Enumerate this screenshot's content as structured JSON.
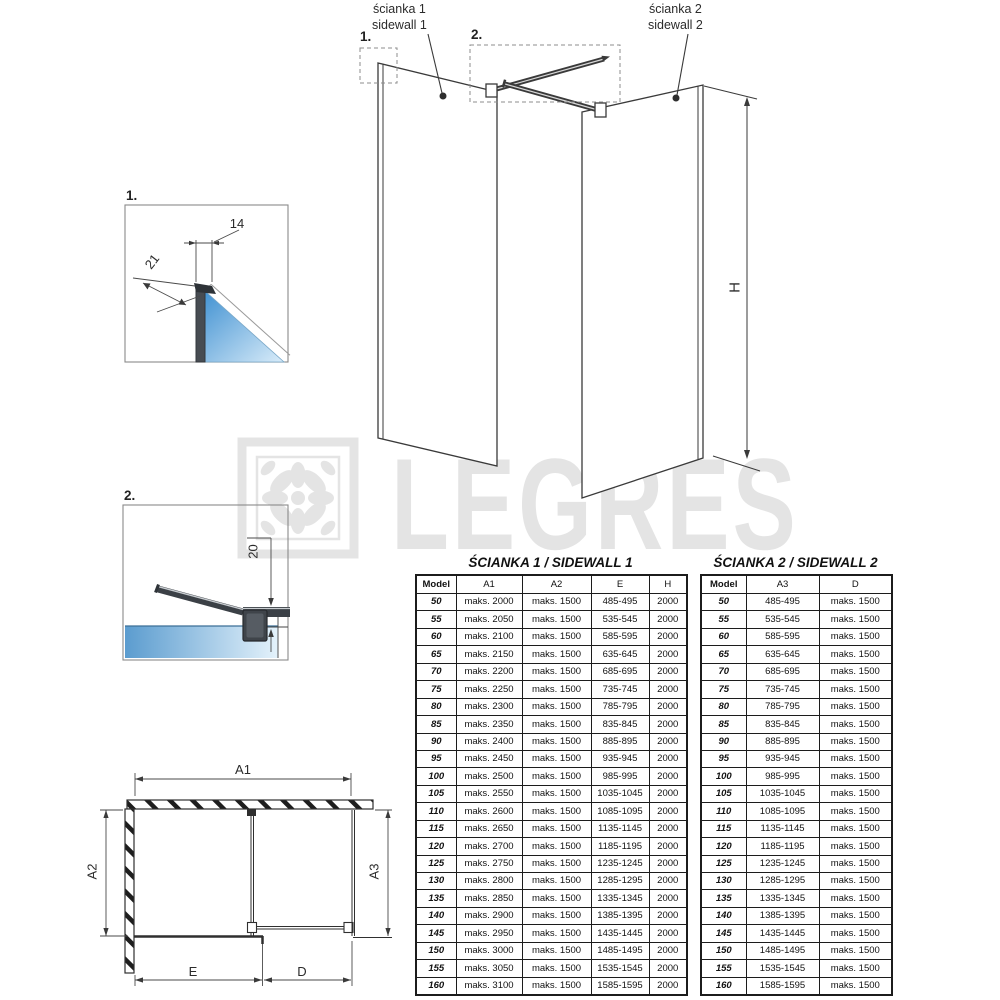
{
  "watermark": {
    "text": "LEGRES",
    "logo_icon": "floral-ornament-icon",
    "color": "#e4e4e4"
  },
  "view3d": {
    "sidewall1_label_pl": "ścianka 1",
    "sidewall1_label_en": "sidewall 1",
    "sidewall2_label_pl": "ścianka 2",
    "sidewall2_label_en": "sidewall 2",
    "detail1_marker": "1.",
    "detail2_marker": "2.",
    "height_dim": "H"
  },
  "detail1": {
    "marker": "1.",
    "dim_top": "14",
    "dim_side": "21"
  },
  "detail2": {
    "marker": "2.",
    "dim": "20"
  },
  "plan": {
    "dim_a1": "A1",
    "dim_a2": "A2",
    "dim_a3": "A3",
    "dim_e": "E",
    "dim_d": "D"
  },
  "tables": {
    "sidewall1": {
      "title": "ŚCIANKA 1 / SIDEWALL 1",
      "columns": [
        "Model",
        "A1",
        "A2",
        "E",
        "H"
      ],
      "rows": [
        [
          "50",
          "maks. 2000",
          "maks. 1500",
          "485-495",
          "2000"
        ],
        [
          "55",
          "maks. 2050",
          "maks. 1500",
          "535-545",
          "2000"
        ],
        [
          "60",
          "maks. 2100",
          "maks. 1500",
          "585-595",
          "2000"
        ],
        [
          "65",
          "maks. 2150",
          "maks. 1500",
          "635-645",
          "2000"
        ],
        [
          "70",
          "maks. 2200",
          "maks. 1500",
          "685-695",
          "2000"
        ],
        [
          "75",
          "maks. 2250",
          "maks. 1500",
          "735-745",
          "2000"
        ],
        [
          "80",
          "maks. 2300",
          "maks. 1500",
          "785-795",
          "2000"
        ],
        [
          "85",
          "maks. 2350",
          "maks. 1500",
          "835-845",
          "2000"
        ],
        [
          "90",
          "maks. 2400",
          "maks. 1500",
          "885-895",
          "2000"
        ],
        [
          "95",
          "maks. 2450",
          "maks. 1500",
          "935-945",
          "2000"
        ],
        [
          "100",
          "maks. 2500",
          "maks. 1500",
          "985-995",
          "2000"
        ],
        [
          "105",
          "maks. 2550",
          "maks. 1500",
          "1035-1045",
          "2000"
        ],
        [
          "110",
          "maks. 2600",
          "maks. 1500",
          "1085-1095",
          "2000"
        ],
        [
          "115",
          "maks. 2650",
          "maks. 1500",
          "1135-1145",
          "2000"
        ],
        [
          "120",
          "maks. 2700",
          "maks. 1500",
          "1185-1195",
          "2000"
        ],
        [
          "125",
          "maks. 2750",
          "maks. 1500",
          "1235-1245",
          "2000"
        ],
        [
          "130",
          "maks. 2800",
          "maks. 1500",
          "1285-1295",
          "2000"
        ],
        [
          "135",
          "maks. 2850",
          "maks. 1500",
          "1335-1345",
          "2000"
        ],
        [
          "140",
          "maks. 2900",
          "maks. 1500",
          "1385-1395",
          "2000"
        ],
        [
          "145",
          "maks. 2950",
          "maks. 1500",
          "1435-1445",
          "2000"
        ],
        [
          "150",
          "maks. 3000",
          "maks. 1500",
          "1485-1495",
          "2000"
        ],
        [
          "155",
          "maks. 3050",
          "maks. 1500",
          "1535-1545",
          "2000"
        ],
        [
          "160",
          "maks. 3100",
          "maks. 1500",
          "1585-1595",
          "2000"
        ]
      ]
    },
    "sidewall2": {
      "title": "ŚCIANKA 2 / SIDEWALL 2",
      "columns": [
        "Model",
        "A3",
        "D"
      ],
      "rows": [
        [
          "50",
          "485-495",
          "maks. 1500"
        ],
        [
          "55",
          "535-545",
          "maks. 1500"
        ],
        [
          "60",
          "585-595",
          "maks. 1500"
        ],
        [
          "65",
          "635-645",
          "maks. 1500"
        ],
        [
          "70",
          "685-695",
          "maks. 1500"
        ],
        [
          "75",
          "735-745",
          "maks. 1500"
        ],
        [
          "80",
          "785-795",
          "maks. 1500"
        ],
        [
          "85",
          "835-845",
          "maks. 1500"
        ],
        [
          "90",
          "885-895",
          "maks. 1500"
        ],
        [
          "95",
          "935-945",
          "maks. 1500"
        ],
        [
          "100",
          "985-995",
          "maks. 1500"
        ],
        [
          "105",
          "1035-1045",
          "maks. 1500"
        ],
        [
          "110",
          "1085-1095",
          "maks. 1500"
        ],
        [
          "115",
          "1135-1145",
          "maks. 1500"
        ],
        [
          "120",
          "1185-1195",
          "maks. 1500"
        ],
        [
          "125",
          "1235-1245",
          "maks. 1500"
        ],
        [
          "130",
          "1285-1295",
          "maks. 1500"
        ],
        [
          "135",
          "1335-1345",
          "maks. 1500"
        ],
        [
          "140",
          "1385-1395",
          "maks. 1500"
        ],
        [
          "145",
          "1435-1445",
          "maks. 1500"
        ],
        [
          "150",
          "1485-1495",
          "maks. 1500"
        ],
        [
          "155",
          "1535-1545",
          "maks. 1500"
        ],
        [
          "160",
          "1585-1595",
          "maks. 1500"
        ]
      ]
    }
  }
}
